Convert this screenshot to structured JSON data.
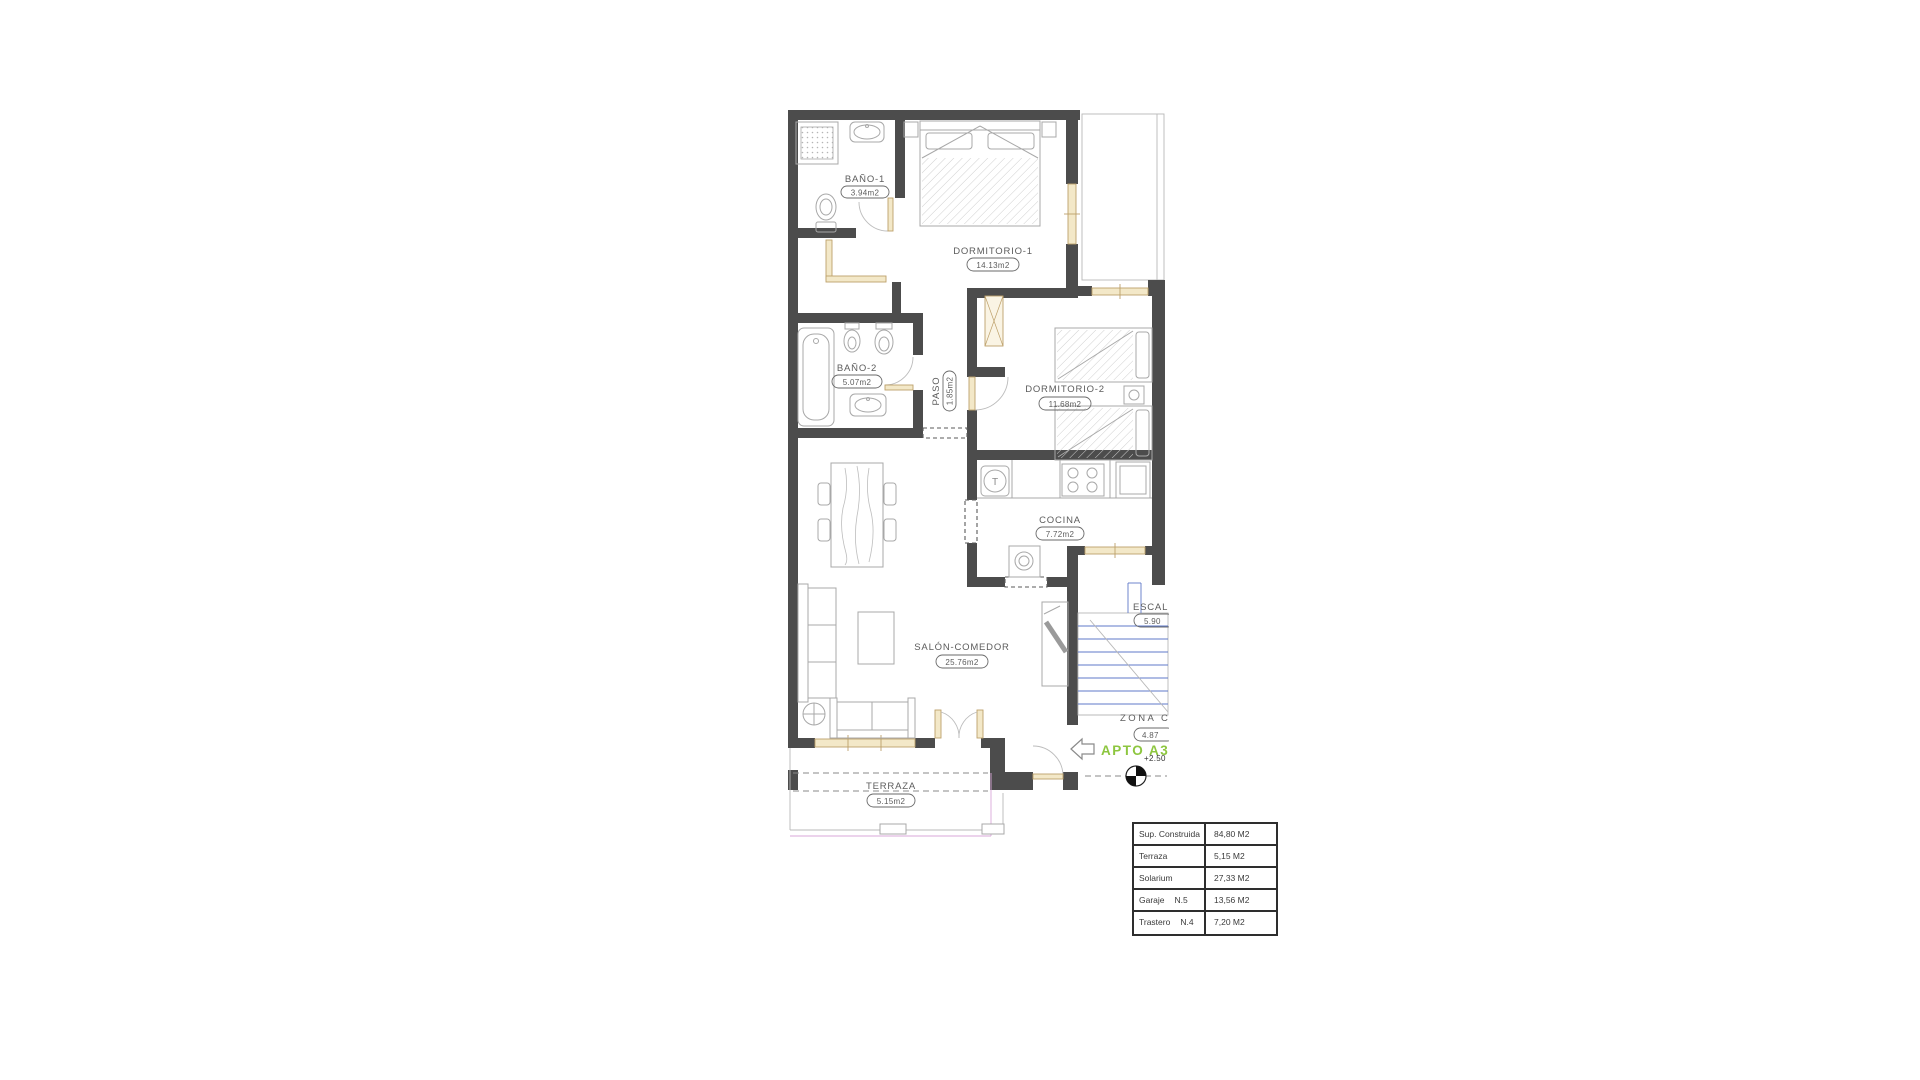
{
  "plan": {
    "rooms": [
      {
        "name": "BAÑO-1",
        "area": "3.94m2"
      },
      {
        "name": "DORMITORIO-1",
        "area": "14.13m2"
      },
      {
        "name": "BAÑO-2",
        "area": "5.07m2"
      },
      {
        "name": "PASO",
        "area": "1.85m2"
      },
      {
        "name": "DORMITORIO-2",
        "area": "11.68m2"
      },
      {
        "name": "COCINA",
        "area": "7.72m2"
      },
      {
        "name": "SALÓN-COMEDOR",
        "area": "25.76m2"
      },
      {
        "name": "TERRAZA",
        "area": "5.15m2"
      },
      {
        "name": "ESCAL",
        "area": "5.90"
      },
      {
        "name": "ZONA C",
        "area": "4.87"
      }
    ],
    "apartment_label": "APTO A3",
    "level_mark": "+2.50",
    "sink_symbol": "T"
  },
  "summary_table": {
    "rows": [
      {
        "label": "Sup. Construida",
        "ref": "",
        "value": "84,80 M2"
      },
      {
        "label": "Terraza",
        "ref": "",
        "value": "5,15 M2"
      },
      {
        "label": "Solarium",
        "ref": "",
        "value": "27,33 M2"
      },
      {
        "label": "Garaje",
        "ref": "N.5",
        "value": "13,56 M2"
      },
      {
        "label": "Trastero",
        "ref": "N.4",
        "value": "7,20 M2"
      }
    ]
  },
  "colors": {
    "wall": "#4c4c4c",
    "window": "#f3e8c8",
    "window_stroke": "#bda06a",
    "furniture": "#a8a8a8",
    "stairs_blue": "#5f79c9",
    "accent_green": "#8dc63f",
    "pink": "#d9a7d9",
    "label_text": "#5c5c5c",
    "table_border": "#2e2e2e"
  }
}
